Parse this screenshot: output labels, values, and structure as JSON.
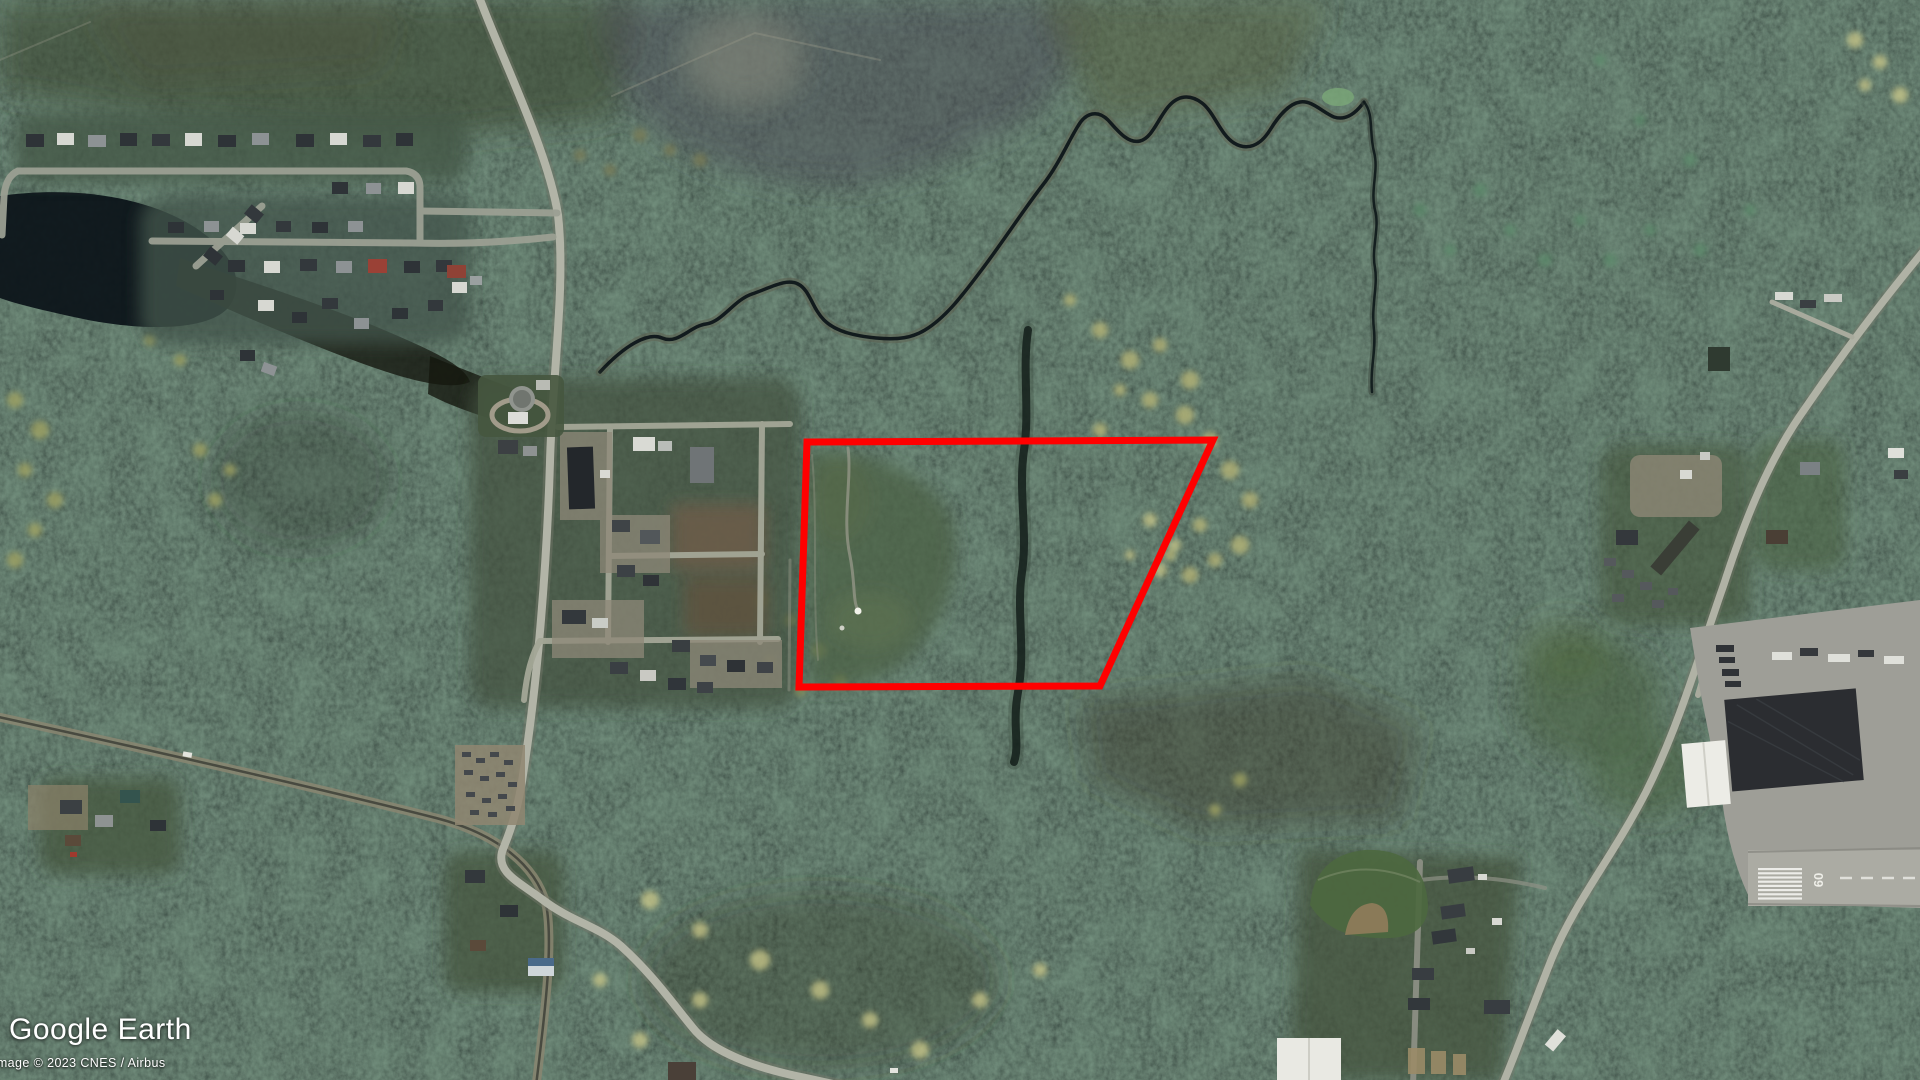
{
  "branding": {
    "logo": "Google Earth"
  },
  "attribution": {
    "imagery_credit": "Image © 2023 CNES / Airbus",
    "year": "2023",
    "provider": "CNES / Airbus"
  },
  "overlay": {
    "parcel_polygon": {
      "points": "807,442 1213,440 1100,686 799,687",
      "color": "#ff0000",
      "stroke_width": 7
    }
  },
  "airport": {
    "runway_marking": "09"
  },
  "visible_features": [
    "conifer-forest",
    "residential-subdivision",
    "lake",
    "wetland-marsh",
    "meandering-stream",
    "main-north-south-road",
    "railway-corridor",
    "commercial-lots",
    "water-treatment-plant",
    "highlighted-parcel",
    "airport-runway",
    "hangar-and-apron",
    "baseball-field",
    "trailer-rows",
    "roadside-houses"
  ],
  "colors": {
    "polygon_red": "#ff0000",
    "forest_dark": "#1b2823",
    "road_grey": "#b2b4a7",
    "water_dark": "#0d151a"
  }
}
